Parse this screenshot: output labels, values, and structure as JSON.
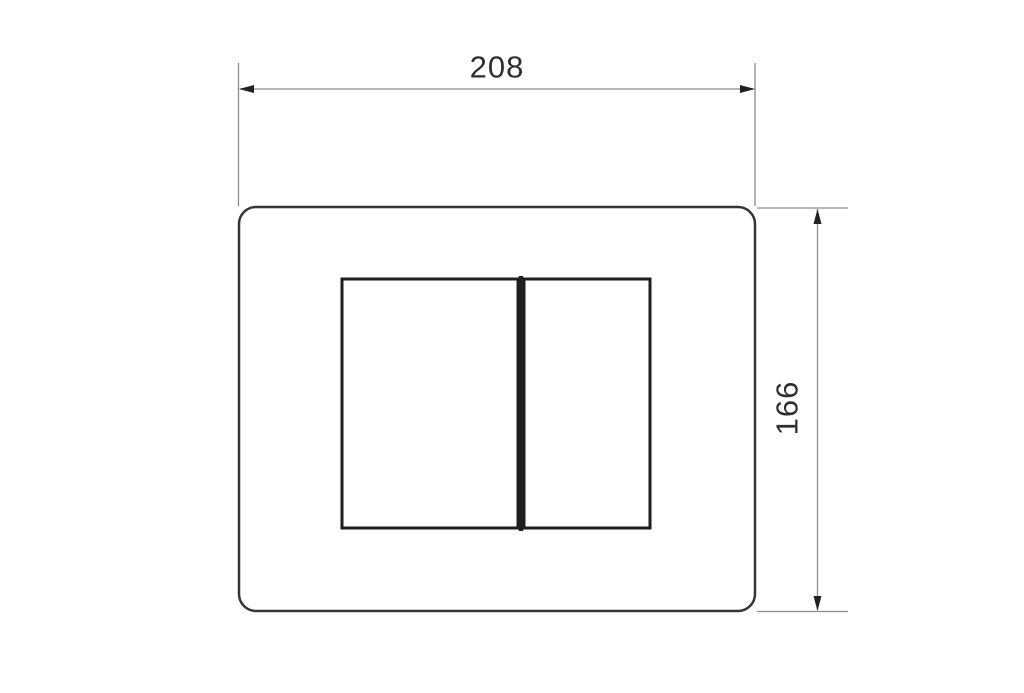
{
  "colors": {
    "bg": "#ffffff",
    "ink": "#353535",
    "button-ink": "#1e1e1e",
    "dim": "#8c8c8c",
    "arrow": "#222222",
    "text": "#2f2f2f"
  },
  "diagram": {
    "type": "technical-drawing",
    "subject": "dual-flush-plate-front-view",
    "width_dimension": {
      "label": "208"
    },
    "height_dimension": {
      "label": "166"
    }
  }
}
